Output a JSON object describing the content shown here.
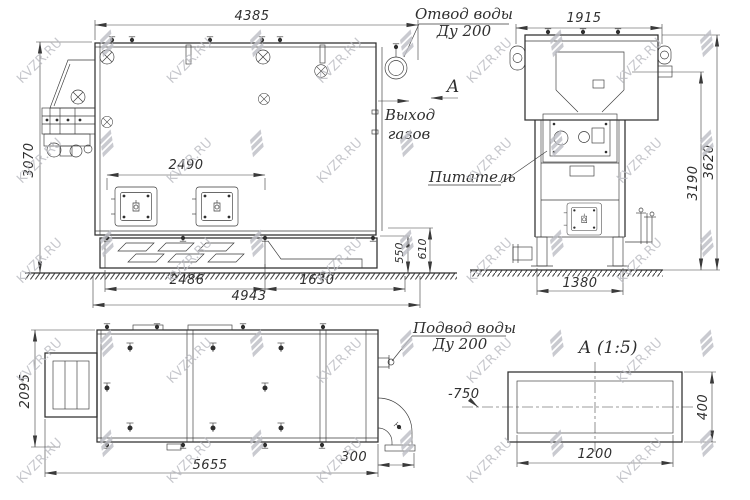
{
  "watermark": {
    "text": "KVZR.RU",
    "color": "#b9bac1"
  },
  "side": {
    "dim_width": "4385",
    "dim_height": "3070",
    "dim_doors": "2490",
    "dim_base_l": "2486",
    "dim_base_r": "1630",
    "dim_total": "4943",
    "dim_h1": "550",
    "dim_h2": "610"
  },
  "callouts": {
    "water_out1": "Отвод воды",
    "water_out2": "Ду 200",
    "section": "А",
    "gas1": "Выход",
    "gas2": "газов"
  },
  "front": {
    "dim_width": "1915",
    "dim_base": "1380",
    "dim_h1": "3190",
    "dim_h2": "3620",
    "feeder": "Питатель"
  },
  "plan": {
    "dim_depth": "2095",
    "dim_length": "5655",
    "dim_pipe": "300",
    "water_in1": "Подвод воды",
    "water_in2": "Ду 200"
  },
  "detail": {
    "title": "А  (1:5)",
    "dim_w": "1200",
    "dim_h": "400",
    "elevation": "-750"
  }
}
